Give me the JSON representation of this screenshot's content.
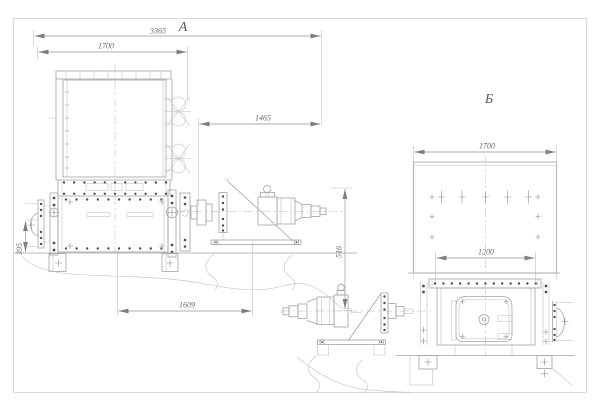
{
  "sheet": {
    "background": "#ffffff",
    "border_color": "#dadada",
    "line_color": "#a3a3a3",
    "bolt_color": "#4f4f4f",
    "text_color": "#6a6a6a"
  },
  "view_a": {
    "label": "А",
    "dims": {
      "overall_width": "3365",
      "hopper_width": "1700",
      "drive_length": "1465",
      "mount_height": "395",
      "drive_height": "516",
      "base_length": "1609"
    }
  },
  "view_b": {
    "label": "Б",
    "dims": {
      "hopper_width": "1700",
      "body_width": "1200"
    }
  }
}
